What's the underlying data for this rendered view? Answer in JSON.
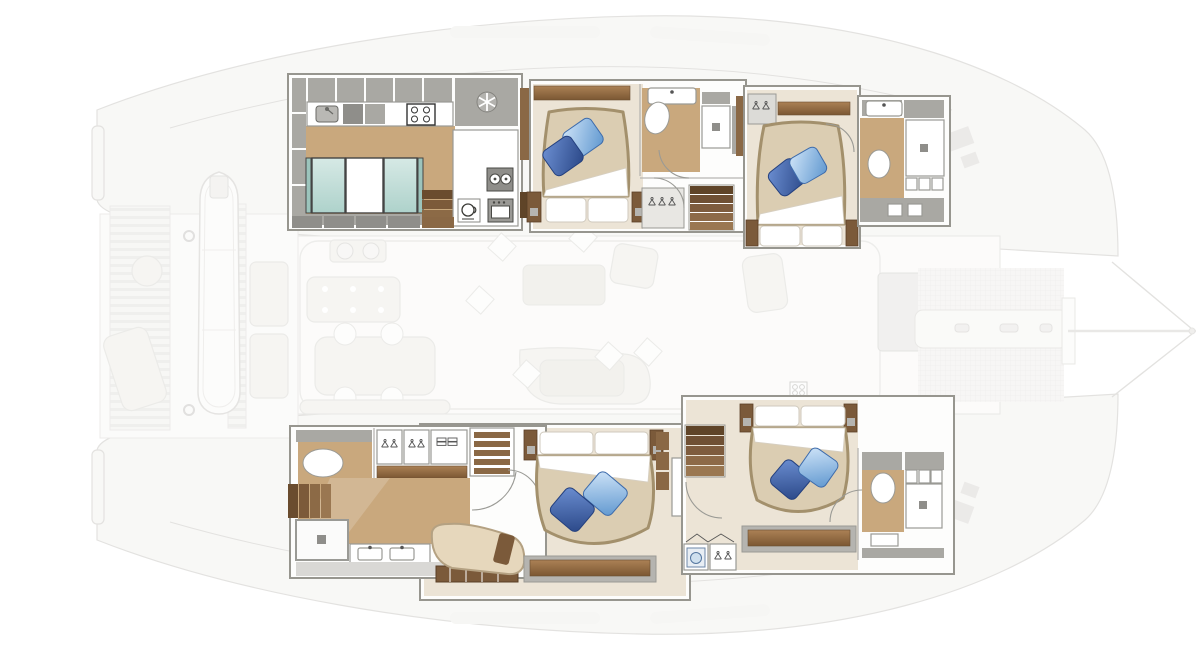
{
  "document": {
    "type": "yacht-floor-plan",
    "subject": "catamaran interior layout, top view, bow to the right",
    "text_labels": []
  },
  "palette": {
    "wood": "#c9a87d",
    "wood_light": "#d8c09a",
    "cream": "#ece4d6",
    "gray_cab": "#a9a8a3",
    "gray_cab_dark": "#8f8e8a",
    "wall_line": "#97968f",
    "duvet": "#dbcdb2",
    "duvet_rim": "#a3906c",
    "shelf_brown": "#8a6845",
    "step_dark": "#6a4c2e",
    "faded_stroke": "#cdccc8",
    "faded_fill": "#f4f3f0",
    "pillow_blue_dark": "#2a4787",
    "pillow_blue_light": "#6ba3d8",
    "fridge_teal": "#aed2cb"
  },
  "highlighted_zones": [
    {
      "id": "galley-starboard-aft",
      "fixtures": [
        "kitchen-sink",
        "cooktop",
        "refrigerator-snowflake",
        "freezer-teal-drawers",
        "steps",
        "island",
        "dishwasher",
        "coffee-machine",
        "oven"
      ]
    },
    {
      "id": "cabin-starboard-mid",
      "fixtures": [
        "double-bed",
        "blue-deco-pillows",
        "nightstands",
        "ensuite-sink",
        "ensuite-toilet",
        "ensuite-shower",
        "hanging-locker",
        "companionway-stairs",
        "doors"
      ]
    },
    {
      "id": "cabin-starboard-fwd",
      "fixtures": [
        "double-bed",
        "blue-deco-pillows",
        "hanging-locker",
        "headboard-shelf",
        "ensuite-sink",
        "ensuite-toilet",
        "ensuite-shower",
        "vanity"
      ]
    },
    {
      "id": "owner-suite-port",
      "fixtures": [
        "double-bed",
        "blue-deco-pillows",
        "chaise-lounge",
        "dresser",
        "wardrobe-hangers",
        "folded-clothes-shelf",
        "book-shelves",
        "toilet-room",
        "shower",
        "double-sink-vanity",
        "steps",
        "side-cabinets"
      ]
    },
    {
      "id": "cabin-port-fwd",
      "fixtures": [
        "double-bed",
        "blue-deco-pillows",
        "companionway-stairs",
        "washing-machine",
        "hanging-locker",
        "dresser",
        "ensuite-sink",
        "ensuite-toilet",
        "ensuite-shower",
        "vanity"
      ]
    }
  ],
  "faded_zones": [
    {
      "id": "aft-platform",
      "fixtures": [
        "tender-dinghy",
        "davit-hooks",
        "teak-slat-deck",
        "round-table",
        "lounger",
        "sunpads",
        "transom-steps"
      ]
    },
    {
      "id": "cockpit",
      "fixtures": [
        "grill-module",
        "cockpit-table",
        "dining-table",
        "chairs",
        "bench-sofa"
      ]
    },
    {
      "id": "salon",
      "fixtures": [
        "coffee-tables",
        "sofas",
        "armchair",
        "scatter-pillows",
        "stove-grid"
      ]
    },
    {
      "id": "foredeck",
      "fixtures": [
        "trampoline-net-top",
        "trampoline-net-bottom",
        "center-walkway",
        "forward-crossbeam",
        "bowsprit",
        "bridle-lines",
        "deck-hatches",
        "mast-step-pad"
      ]
    }
  ]
}
